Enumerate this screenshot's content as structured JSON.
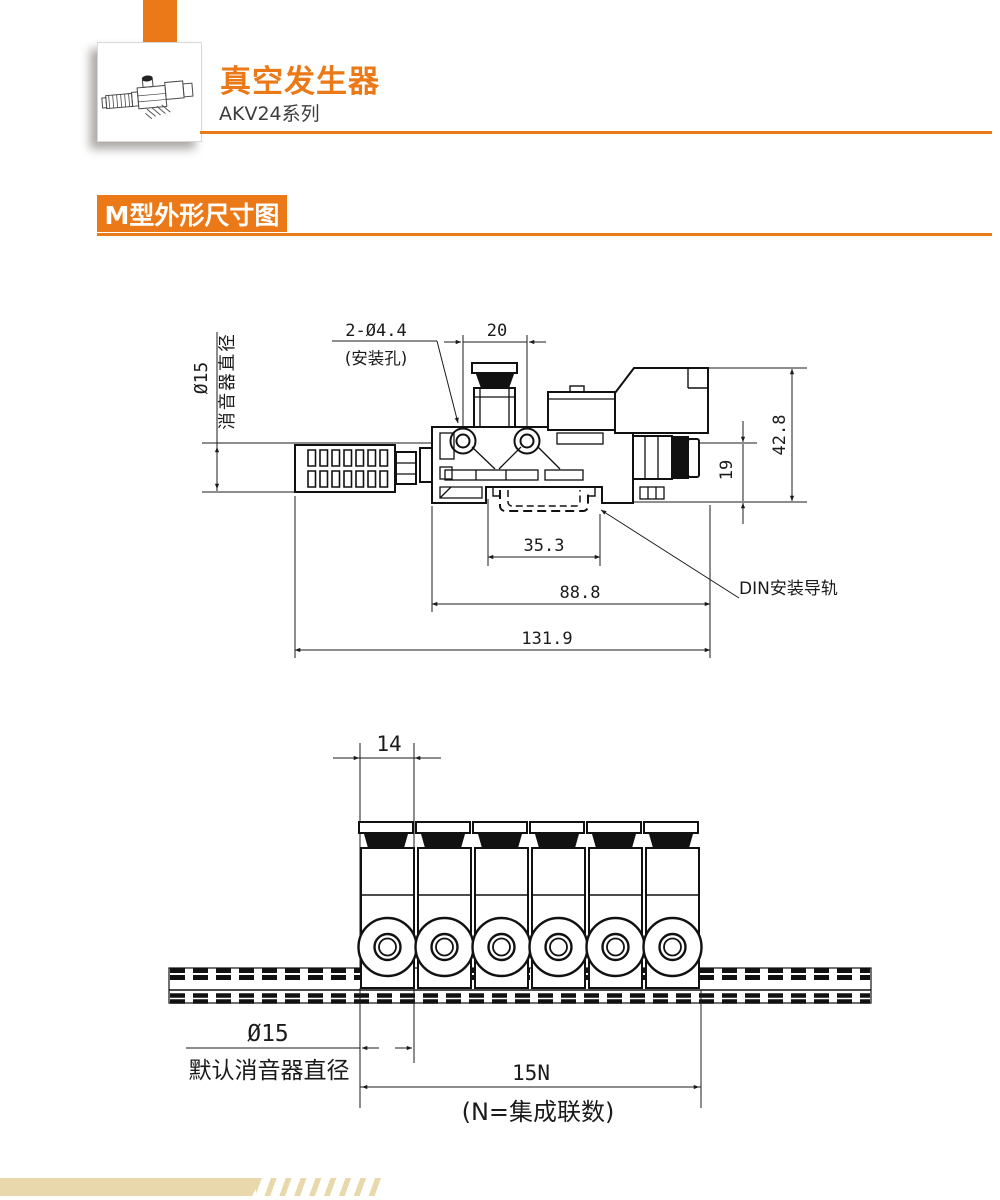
{
  "header": {
    "title": "真空发生器",
    "series": "AKV24系列",
    "accent_color": "#EB7917"
  },
  "section": {
    "label": "M型外形尺寸图"
  },
  "figure1": {
    "name": "side-view-dimension-drawing",
    "dims": {
      "silencer_dia": "Ø15",
      "silencer_dia_note": "消音器直径",
      "holes_line1": "2-Ø4.4",
      "holes_line2": "(安装孔)",
      "d20": "20",
      "d42_8": "42.8",
      "d19": "19",
      "d35_3": "35.3",
      "d88_8": "88.8",
      "d131_9": "131.9",
      "din_rail": "DIN安装导轨"
    }
  },
  "figure2": {
    "name": "front-view-manifold-drawing",
    "module_count": 6,
    "dims": {
      "d14": "14",
      "dia": "Ø15",
      "dia_note": "默认消音器直径",
      "d15n": "15N",
      "n_note": "(N=集成联数)"
    }
  },
  "footer": {
    "bar_color": "#E8D8AB"
  }
}
